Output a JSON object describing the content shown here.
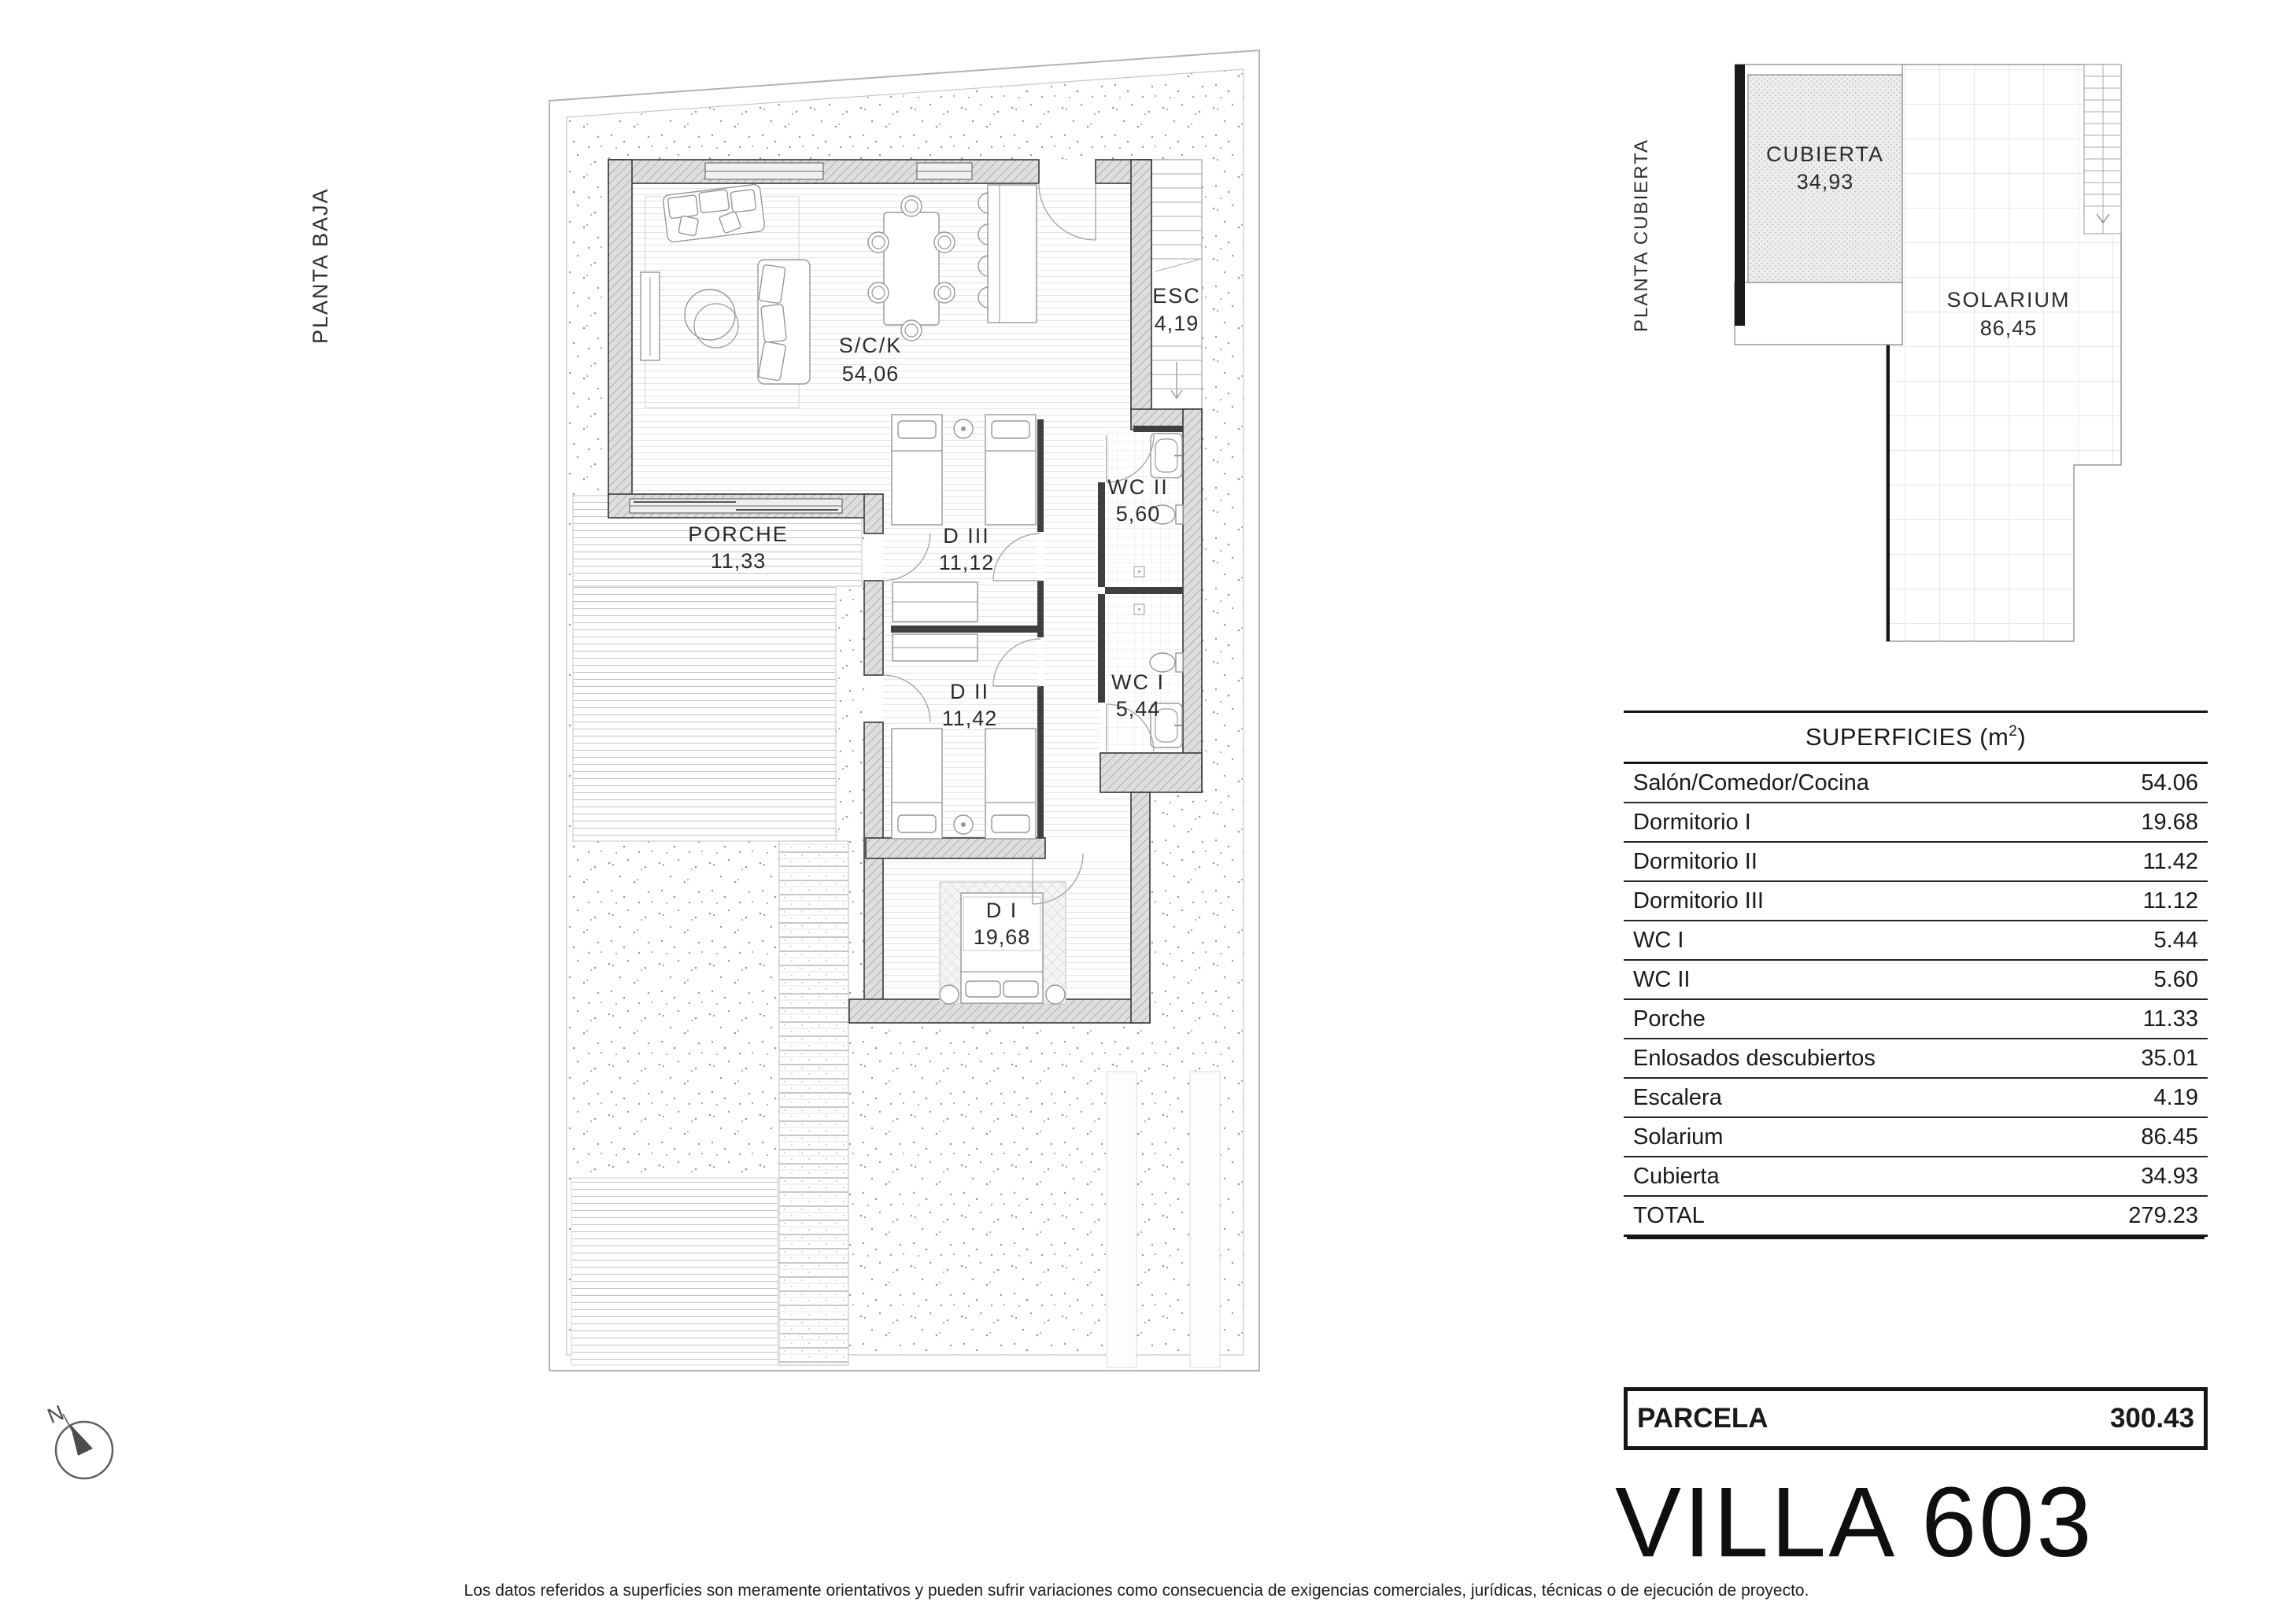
{
  "ground_floor": {
    "label": "PLANTA BAJA",
    "compass_n": "N",
    "rooms": {
      "sck": {
        "name": "S/C/K",
        "area": "54,06"
      },
      "esc": {
        "name": "ESC",
        "area": "4,19"
      },
      "porche": {
        "name": "PORCHE",
        "area": "11,33"
      },
      "d3": {
        "name": "D III",
        "area": "11,12"
      },
      "d2": {
        "name": "D II",
        "area": "11,42"
      },
      "d1": {
        "name": "D I",
        "area": "19,68"
      },
      "wc2": {
        "name": "WC II",
        "area": "5,60"
      },
      "wc1": {
        "name": "WC I",
        "area": "5,44"
      }
    }
  },
  "roof_plan": {
    "label": "PLANTA CUBIERTA",
    "rooms": {
      "cubierta": {
        "name": "CUBIERTA",
        "area": "34,93"
      },
      "solarium": {
        "name": "SOLARIUM",
        "area": "86,45"
      }
    }
  },
  "surfaces_table": {
    "title_prefix": "SUPERFICIES (m",
    "title_sup": "2",
    "title_suffix": ")",
    "rows": [
      {
        "label": "Salón/Comedor/Cocina",
        "value": "54.06"
      },
      {
        "label": "Dormitorio I",
        "value": "19.68"
      },
      {
        "label": "Dormitorio II",
        "value": "11.42"
      },
      {
        "label": "Dormitorio III",
        "value": "11.12"
      },
      {
        "label": "WC I",
        "value": "5.44"
      },
      {
        "label": "WC II",
        "value": "5.60"
      },
      {
        "label": "Porche",
        "value": "11.33"
      },
      {
        "label": "Enlosados descubiertos",
        "value": "35.01"
      },
      {
        "label": "Escalera",
        "value": "4.19"
      },
      {
        "label": "Solarium",
        "value": "86.45"
      },
      {
        "label": "Cubierta",
        "value": "34.93"
      },
      {
        "label": "TOTAL",
        "value": "279.23"
      }
    ]
  },
  "parcela": {
    "label": "PARCELA",
    "value": "300.43"
  },
  "villa_title": "VILLA 603",
  "disclaimer": "Los datos referidos a superficies son meramente orientativos y pueden sufrir variaciones como consecuencia de exigencias comerciales, jurídicas, técnicas o de ejecución de proyecto."
}
